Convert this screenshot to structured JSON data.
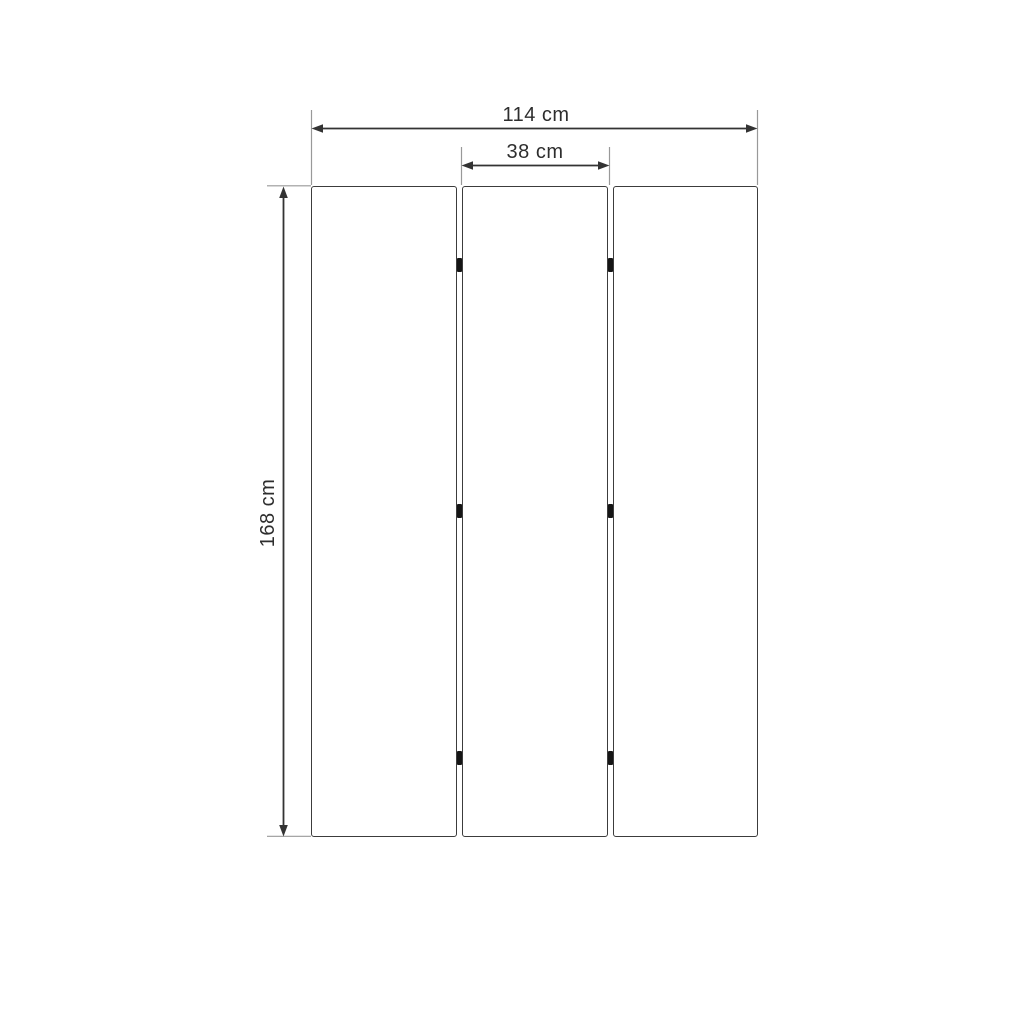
{
  "diagram": {
    "type": "dimension-drawing",
    "panel_count": 3,
    "hinge_count": 6,
    "labels": {
      "total_width": "114 cm",
      "panel_width": "38 cm",
      "height": "168 cm"
    },
    "colors": {
      "background": "#ffffff",
      "panel_outline": "#3c3c3c",
      "dimension_line": "#333333",
      "extension_line": "#999999",
      "hinge": "#151515",
      "label_text": "#2e2e2e"
    }
  }
}
